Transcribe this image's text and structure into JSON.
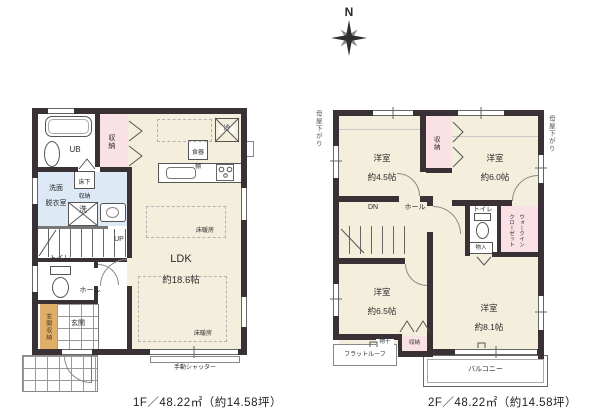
{
  "compass": {
    "north": "N"
  },
  "colors": {
    "wall": "#3a3136",
    "room_cream": "#f4efdc",
    "closet_pink": "#f9e1e5",
    "wet_blue": "#dde9f4",
    "storage_tan": "#dfae68"
  },
  "floor1": {
    "caption": "1F／48.22㎡（約14.58坪）",
    "ldk": {
      "name": "LDK",
      "size": "約18.6帖"
    },
    "bath": "UB",
    "washroom": {
      "line1": "洗面",
      "line2": "脱衣室"
    },
    "underfloor_storage": {
      "line1": "床下",
      "line2": "収納"
    },
    "cupboard": {
      "line1": "食器",
      "line2": "棚"
    },
    "washer": "洗",
    "fridge": "冷",
    "toilet": "トイレ",
    "hall": "ホール",
    "stairs_up": "UP",
    "closet": "収納",
    "entrance": "玄関",
    "entrance_storage": "玄関収納",
    "floor_heating": "床暖房",
    "shutter": "手動シャッター"
  },
  "floor2": {
    "caption": "2F／48.22㎡（約14.58坪）",
    "room_nw": {
      "name": "洋室",
      "size": "約4.5帖"
    },
    "room_ne": {
      "name": "洋室",
      "size": "約6.0帖"
    },
    "room_sw": {
      "name": "洋室",
      "size": "約6.5帖"
    },
    "room_se": {
      "name": "洋室",
      "size": "約8.1帖"
    },
    "stairs_down": "DN",
    "hall": "ホール",
    "toilet": "トイレ",
    "storage_box": "物入",
    "wic": {
      "line1": "ウォークイン",
      "line2": "クローゼット"
    },
    "closet_top": "収納",
    "closet_bottom": "収納",
    "flat_roof": "フラットルーフ",
    "balcony": "バルコニー",
    "laundry": "物干",
    "roof_slope_left": "母屋下がり",
    "roof_slope_right": "母屋下がり"
  }
}
